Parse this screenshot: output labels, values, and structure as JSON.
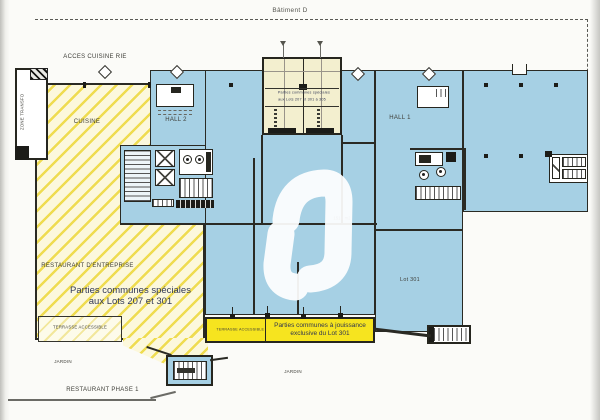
{
  "colors": {
    "plan_blue": "#a6d0e4",
    "hatch_yellow_stripe": "#efdc50",
    "hatch_yellow_bg": "#fcf8dc",
    "bright_yellow": "#f6e41f",
    "pale_core_box": "#f3efcf",
    "wall_ink": "#2a2a24"
  },
  "plan": {
    "building_label": "Bâtiment D",
    "labels": {
      "acces_cuisine": "ACCES CUISINE RIE",
      "zone_transfo": "ZONE TRANSFO",
      "cuisine": "CUISINE",
      "hall_2": "HALL 2",
      "hall_1": "HALL 1",
      "core_box": {
        "line1": "Parties communes spéciales",
        "line2": "aux Lots 207 et 301 à 305"
      },
      "restaurant_entreprise": "RESTAURANT D'ENTREPRISE",
      "parties_speciales": {
        "line1": "Parties communes spéciales",
        "line2": "aux Lots 207 et 301"
      },
      "terrasse_left": "TERRASSE ACCESSIBLE",
      "terrasse_mid": "TERRASSE ACCESSIBLE",
      "jouissance": {
        "line1": "Parties communes à jouissance",
        "line2": "exclusive du Lot 301"
      },
      "lot_301": "Lot 301",
      "area_m2": "1514 m2",
      "jardin_left": "JARDIN",
      "jardin_mid": "JARDIN",
      "restaurant_phase1": "RESTAURANT PHASE 1"
    }
  }
}
